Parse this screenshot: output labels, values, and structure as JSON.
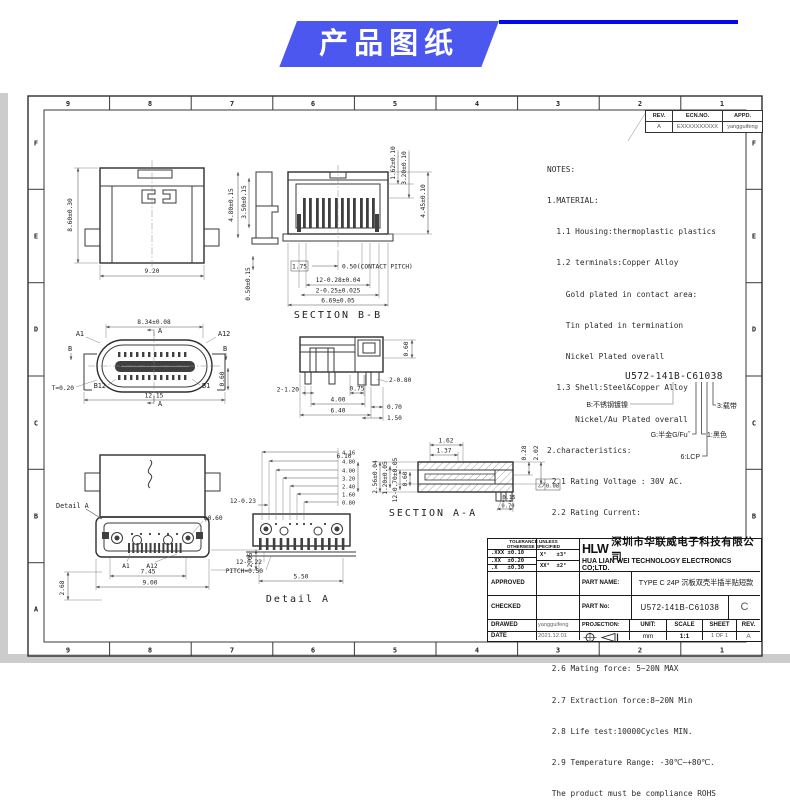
{
  "banner": {
    "title": "产品图纸"
  },
  "frame": {
    "cols": [
      "9",
      "8",
      "7",
      "6",
      "5",
      "4",
      "3",
      "2",
      "1"
    ],
    "rows": [
      "F",
      "E",
      "D",
      "C",
      "B",
      "A"
    ]
  },
  "revision_table": {
    "h_rev": "REV.",
    "h_ecn": "ECN.NO.",
    "h_appd": "APPD.",
    "rev": "A",
    "ecn": "EXXXXXXXXXX",
    "appd": "yangguifeng"
  },
  "notes": {
    "lines": [
      "NOTES:",
      "1.MATERIAL:",
      "  1.1 Housing:thermoplastic plastics",
      "  1.2 terminals:Copper Alloy",
      "    Gold plated in contact area:",
      "    Tin plated in termination",
      "    Nickel Plated overall",
      "  1.3 Shell:Steel&Copper Alloy",
      "      Nickel/Au Plated overall",
      "2.characteristics:",
      " 2.1 Rating Voltage : 30V AC.",
      " 2.2 Rating Current:",
      "     5A for Vbus PIN;1.25A for Vconn PIN",
      " 2.3 Contact Resistance:40 mΩ MAX.",
      " 2.4 Insulation Resistance:100 MΩ MIN.",
      " 2.5 Withstanding Voltage:AC 100V",
      " 2.6 Mating force: 5~20N MAX",
      " 2.7 Extraction force:8~20N Min",
      " 2.8 Life test:10000Cycles MIN.",
      " 2.9 Temperature Range: -30℃~+80℃.",
      " The product must be compliance ROHS"
    ]
  },
  "part_code": {
    "number": "U572-141B-C61038",
    "shell": "B:不锈钢镀镍",
    "plating": "G:半金G/Fu˝",
    "material": "6:LCP",
    "color": "1:黑色",
    "tape": "3:载带"
  },
  "views": {
    "top": {
      "h": "8.60±0.30",
      "w": "9.20"
    },
    "side_profile": {
      "d1": "4.80±0.15",
      "d2": "3.50±0.15",
      "d3": "0.50±0.15"
    },
    "section_bb": {
      "title": "SECTION B-B",
      "r1": "1.62±0.10",
      "r2": "3.20±0.10",
      "r3": "4.45±0.10",
      "pitch_ref": "1.75",
      "pitch": "0.50(CONTACT PITCH)",
      "terms": "12-0.28±0.04",
      "posts": "2-0.25±0.025",
      "width": "6.69±0.05"
    },
    "front": {
      "top": "8.34±0.08",
      "t": "T=0.20",
      "a1": "A1",
      "a12": "A12",
      "b12": "B12",
      "b1": "B1",
      "a": "A",
      "b": "B",
      "w": "12.15",
      "leg": "0.60"
    },
    "side": {
      "d1": "2-1.20",
      "d2": "0.75",
      "d3": "4.00",
      "d4": "6.40",
      "d5": "2-0.80",
      "d6": "0.70",
      "d7": "1.50",
      "d8": "0.60"
    },
    "section_aa": {
      "title": "SECTION A-A",
      "t1": "1.62",
      "t2": "1.37",
      "v1": "2.56±0.04",
      "v2": "1.20±0.05",
      "v3": "12-0.70±0.05",
      "v4": "0.60",
      "len": "6.10",
      "b1": "0.15",
      "b2": "0.70",
      "r1": "0.28",
      "r2": "2.02",
      "fcf": "0.08"
    },
    "bottom": {
      "callout": "Detail A",
      "hole": "φ0.60",
      "a1": "A1",
      "a12": "A12",
      "span": "7.45",
      "w": "9.00",
      "h": "2.05",
      "pin": "2.68"
    },
    "detail_a": {
      "title": "Detail A",
      "l1": "12-0.23",
      "l2": "12-0.22",
      "l3": "PITCH=0.50",
      "bottom": "5.50",
      "stack": [
        "4.16",
        "4.80",
        "4.00",
        "3.20",
        "2.40",
        "1.60",
        "0.80"
      ]
    }
  },
  "title_block": {
    "tol_header1": "TOLERANCE UNLESS",
    "tol_header2": "OTHERWISE SPECIFIED",
    "tol1": ".XXX ±0.10",
    "tol2": ".XX  ±0.20",
    "tol3": ".X   ±0.30",
    "ang1": "X°   ±3°",
    "ang2": "XX°  ±2°",
    "logo": "HLW",
    "company_cn": "深圳市华联威电子科技有限公司",
    "company_en": "HUA LIAN WEI TECHNOLOGY ELECTRONICS CO;LTD.",
    "approved": "APPROVED",
    "checked": "CHECKED",
    "drawed": "DRAWED",
    "date_label": "DATE",
    "drawed_by": "yangguifeng",
    "date": "2021.12.01",
    "part_name_label": "PART NAME:",
    "part_name": "TYPE C 24P 沉板双壳半插半贴短款",
    "part_no_label": "PART No:",
    "part_no": "U572-141B-C61038",
    "part_rev": "C",
    "projection": "PROJECTION:",
    "unit_label": "UNIT:",
    "unit": "mm",
    "scale_label": "SCALE",
    "scale": "1:1",
    "sheet_label": "SHEET",
    "sheet": "1 OF 1",
    "rev_label": "REV.",
    "rev": "A"
  }
}
